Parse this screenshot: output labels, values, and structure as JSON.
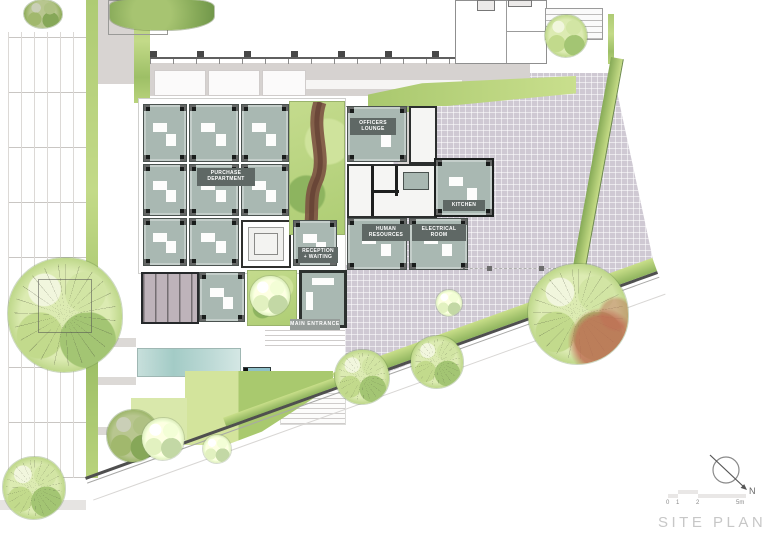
{
  "plan": {
    "title": "SITE PLAN",
    "north_label": "N",
    "scale_ticks": [
      "0",
      "1",
      "2",
      "5m"
    ],
    "rooms": {
      "purchase": "PURCHASE\nDEPARTMENT",
      "officers_lounge": "OFFICERS\nLOUNGE",
      "human_resources": "HUMAN\nRESOURCES",
      "electrical": "ELECTRICAL\nROOM",
      "kitchen": "KITCHEN",
      "reception": "RECEPTION\n+ WAITING",
      "main_entrance": "MAIN ENTRANCE",
      "entrance": "ENTRANCE"
    },
    "colors": {
      "room_floor": "#a9b8b2",
      "room_wall": "#4a524f",
      "plaza": "#cfc9d3",
      "hedge_green": "#b9d37c",
      "lawn_green": "#cfe29a",
      "pool_blue": "#b5d6d2",
      "path_brown": "#7b5142",
      "tree_red": "#c97f68",
      "title_gray": "#c7c7c7"
    }
  }
}
